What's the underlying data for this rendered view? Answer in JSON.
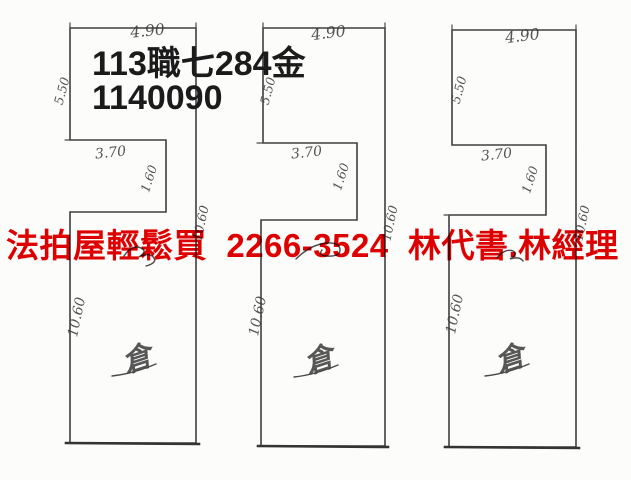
{
  "header": {
    "case_label": "113職七284金",
    "case_number": "1140090"
  },
  "watermark": {
    "text": "法拍屋輕鬆買  2266-3524  林代書.林經理",
    "color": "#e10000"
  },
  "drawing": {
    "line_color": "#3f3f3f",
    "paper_color": "#fcfcfa",
    "plans": [
      {
        "position": "left",
        "room_label": "倉",
        "dims": {
          "top_width": "4.90",
          "left_upper": "5.50",
          "notch_width": "3.70",
          "notch_height": "1.60",
          "left_lower": "10.60",
          "right_side": "10.60"
        }
      },
      {
        "position": "middle",
        "room_label": "倉",
        "dims": {
          "top_width": "4.90",
          "left_upper": "5.50",
          "notch_width": "3.70",
          "notch_height": "1.60",
          "left_lower": "10.60",
          "right_side": "10.60"
        }
      },
      {
        "position": "right",
        "room_label": "倉",
        "dims": {
          "top_width": "4.90",
          "left_upper": "5.50",
          "notch_width": "3.70",
          "notch_height": "1.60",
          "left_lower": "10.60",
          "right_side": "10.60"
        }
      }
    ]
  }
}
